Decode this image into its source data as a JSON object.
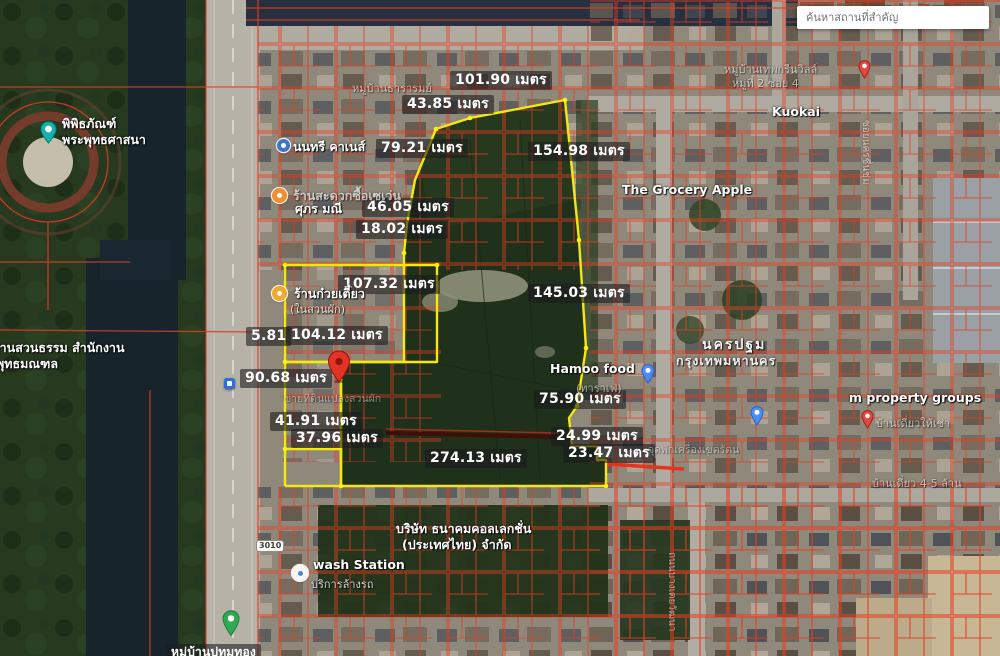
{
  "search": {
    "placeholder": "ค้นหาสถานที่สำคัญ"
  },
  "shield": {
    "label": "3010"
  },
  "colors": {
    "boundary": "#f6e70c",
    "parcel_lines": "#e63c22",
    "pin": "#e33326",
    "water": "#17242c"
  },
  "measurements": [
    {
      "id": "top-edge",
      "text": "101.90 เมตร"
    },
    {
      "id": "top-left-edge",
      "text": "43.85 เมตร"
    },
    {
      "id": "upper-west-edge",
      "text": "79.21 เมตร"
    },
    {
      "id": "upper-east-edge",
      "text": "154.98 เมตร"
    },
    {
      "id": "west-edge-2",
      "text": "46.05 เมตร"
    },
    {
      "id": "west-edge-3",
      "text": "18.02 เมตร"
    },
    {
      "id": "parcel-top-edge",
      "text": "107.32 เมตร"
    },
    {
      "id": "east-edge-2",
      "text": "145.03 เมตร"
    },
    {
      "id": "parcel-bottom-edge",
      "text": "104.12 เมตร"
    },
    {
      "id": "tiny-edge",
      "text": "5.81"
    },
    {
      "id": "strip-west-edge",
      "text": "90.68 เมตร"
    },
    {
      "id": "strip-edge-2",
      "text": "41.91 เมตร"
    },
    {
      "id": "strip-edge-3",
      "text": "37.96 เมตร"
    },
    {
      "id": "south-edge",
      "text": "274.13 เมตร"
    },
    {
      "id": "east-edge-3",
      "text": "75.90 เมตร"
    },
    {
      "id": "notch-edge-1",
      "text": "24.99 เมตร"
    },
    {
      "id": "notch-edge-2",
      "text": "23.47 เมตร"
    }
  ],
  "places": [
    {
      "name": "พิพิธภัณฑ์",
      "sub": "พระพุทธศาสนา"
    },
    {
      "name": "นนทรี คาเนส์"
    },
    {
      "name": "ร้านสะดวกซื้อเซเว่น"
    },
    {
      "name": "ศุภร มณี"
    },
    {
      "name": "ร้านก๋วยเตี๋ยว",
      "sub": "(ในสวนผัก)"
    },
    {
      "name": "ขายที่ดินแปลงสวนผัก"
    },
    {
      "name": "Hamoo food",
      "sub": "(ทาราเฟ่)"
    },
    {
      "name": "นครปฐม"
    },
    {
      "name": "กรุงเทพมหานคร"
    },
    {
      "name": "The Grocery Apple"
    },
    {
      "name": "Kuokai"
    },
    {
      "name": "หมู่บ้านเทพกรีนวิลล์",
      "sub": "หมู่ที่ 2 ซอย 4"
    },
    {
      "name": "m property groups",
      "sub": "บ้านเดี่ยวให้เช่า"
    },
    {
      "name": "จุดพักเครื่องเขตรัตน"
    },
    {
      "name": "บริษัท ธนาคมคอลเลกชั่น",
      "sub": "(ประเทศไทย) จำกัด"
    },
    {
      "name": "wash Station",
      "sub": "บริการล้างรถ"
    },
    {
      "name": "ลานสวนธรรม สำนักงาน",
      "sub": "พุทธมณฑล"
    },
    {
      "name": "หมู่บ้านธารารมย์"
    },
    {
      "name": "บ้านเดี่ยว 4-5 ล้าน"
    },
    {
      "name": "ถนนบางเตยวัฒนา"
    },
    {
      "name": "ซอยนครชื่นชุ่ม"
    },
    {
      "name": "หมู่บ้านปทุมทอง"
    }
  ]
}
